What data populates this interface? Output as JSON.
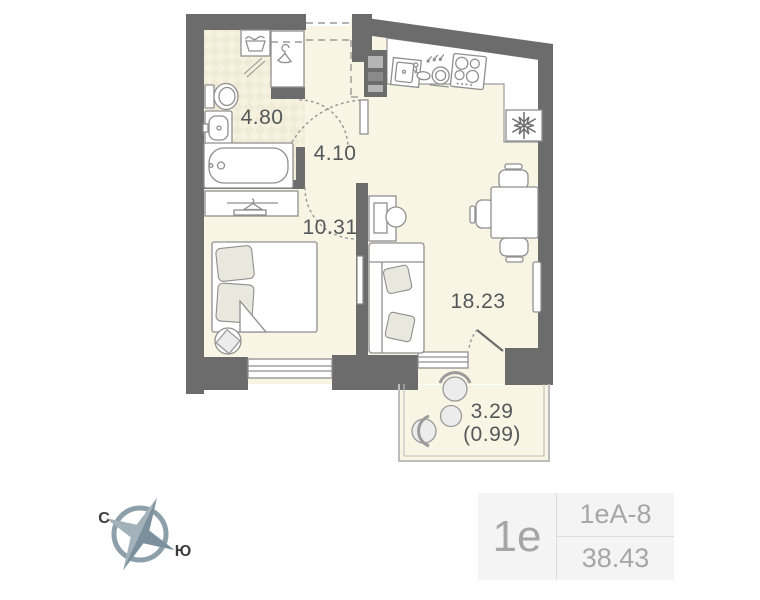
{
  "floor_plan": {
    "rooms": [
      {
        "id": "bathroom",
        "area": "4.80"
      },
      {
        "id": "hallway",
        "area": "4.10"
      },
      {
        "id": "bedroom",
        "area": "10.31"
      },
      {
        "id": "living-kitchen",
        "area": "18.23"
      },
      {
        "id": "balcony",
        "area": "3.29",
        "area_coefficient": "(0.99)"
      }
    ]
  },
  "compass": {
    "north": "С",
    "south": "Ю"
  },
  "info_panel": {
    "apartment_type": "1е",
    "layout_code": "1еА-8",
    "total_area": "38.43"
  },
  "colors": {
    "wall": "#6c6c6c",
    "floor": "#f9f5e4",
    "floor_tile_alt": "#f0ebd6",
    "label_text": "#53585b",
    "panel_bg": "#f4f4f4",
    "panel_text": "#a6a6a6",
    "compass": "#8d9fab"
  }
}
